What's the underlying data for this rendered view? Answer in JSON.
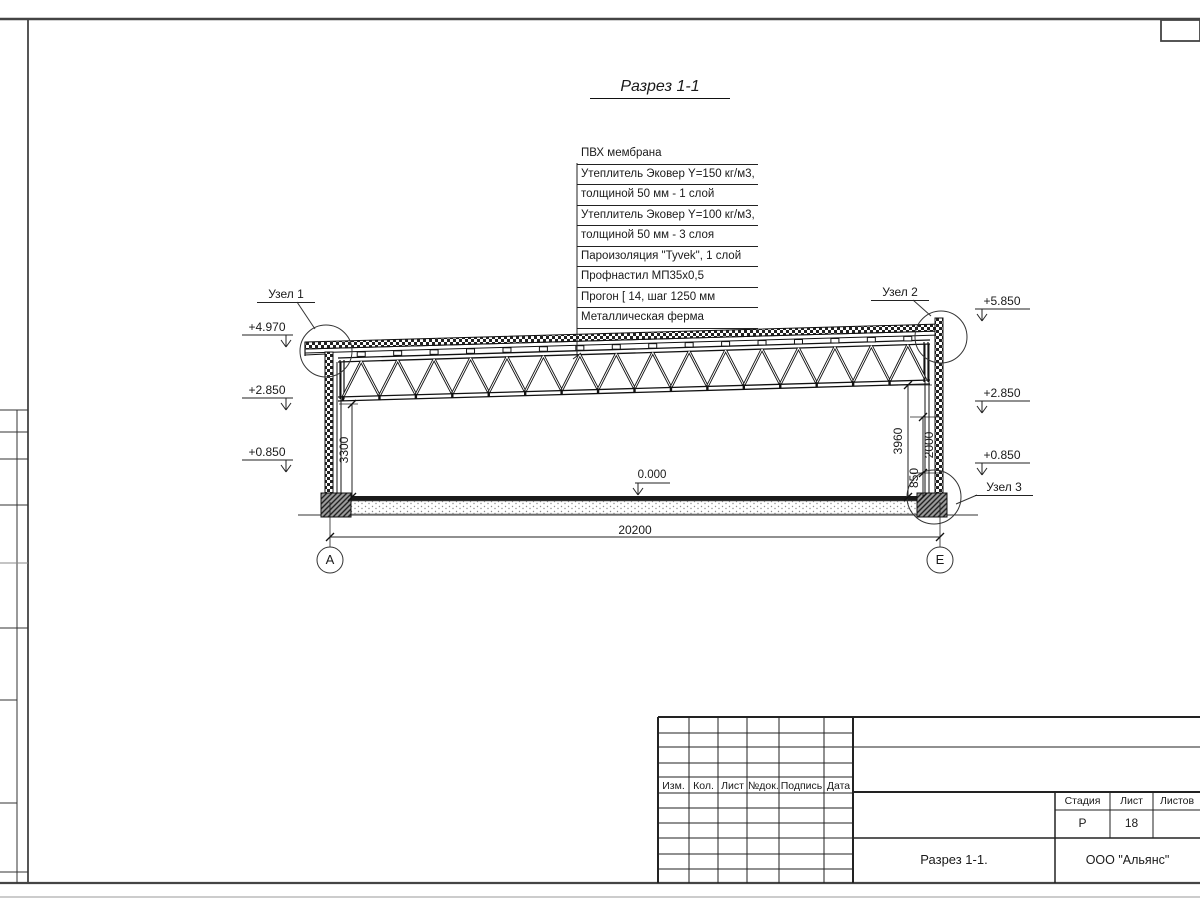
{
  "page": {
    "title": "Разрез 1-1"
  },
  "callout": {
    "lines": [
      "ПВХ мембрана",
      "Утеплитель Эковер Y=150 кг/м3,",
      "толщиной 50 мм - 1 слой",
      "Утеплитель Эковер Y=100 кг/м3,",
      "толщиной 50 мм - 3 слоя",
      "Пароизоляция \"Tyvek\", 1 слой",
      "Профнастил МП35х0,5",
      "Прогон [ 14, шаг 1250 мм",
      "Металлическая ферма"
    ]
  },
  "details": {
    "node1": "Узел 1",
    "node2": "Узел 2",
    "node3": "Узел 3"
  },
  "elevations": {
    "left": [
      "+4.970",
      "+2.850",
      "+0.850"
    ],
    "right": [
      "+5.850",
      "+2.850",
      "+0.850"
    ],
    "floor": "0.000"
  },
  "dimensions": {
    "span": "20200",
    "left_height": "3300",
    "right_height": "3960",
    "upper": "2000",
    "lower": "850"
  },
  "grid": {
    "left": "А",
    "right": "Е"
  },
  "title_block": {
    "columns": [
      "Изм.",
      "Кол.",
      "Лист",
      "№док.",
      "Подпись",
      "Дата"
    ],
    "stage_label": "Стадия",
    "sheet_label": "Лист",
    "sheets_label": "Листов",
    "stage": "Р",
    "sheet": "18",
    "drawing_title": "Разрез 1-1.",
    "company": "ООО \"Альянс\""
  },
  "colors": {
    "line": "#1a1a1a",
    "frame": "#444444"
  }
}
